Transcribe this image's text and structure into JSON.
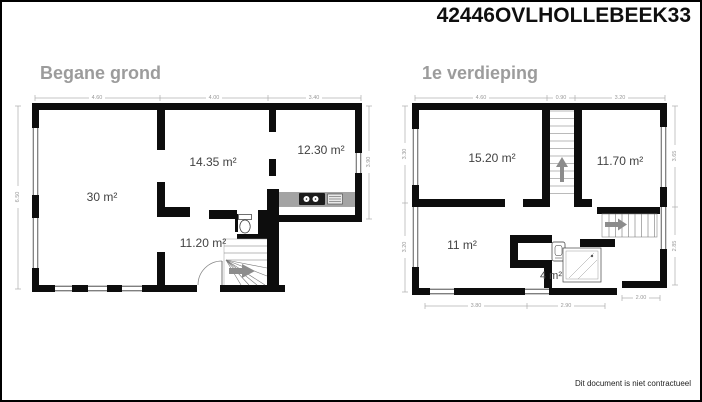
{
  "header": {
    "title": "42446OVLHOLLEBEEK33"
  },
  "footer": {
    "disclaimer": "Dit document is niet contractueel"
  },
  "ground_floor": {
    "title": "Begane grond",
    "rooms": {
      "living": "30 m²",
      "middle": "14.35 m²",
      "kitchen": "12.30 m²",
      "hall": "11.20 m²"
    },
    "dims": {
      "top_left": "4.60",
      "top_mid": "4.00",
      "top_right": "3.40",
      "left": "6.50",
      "right": "3.90"
    }
  },
  "first_floor": {
    "title": "1e verdieping",
    "rooms": {
      "bedroom_left": "15.20 m²",
      "bedroom_right": "11.70 m²",
      "bedroom_bottom": "11 m²",
      "bathroom": "4 m²"
    },
    "dims": {
      "top_left": "4.60",
      "top_mid": "0.90",
      "top_right": "3.20",
      "left_top": "3.30",
      "left_bottom": "3.20",
      "right_top": "3.65",
      "right_bottom": "2.85",
      "bottom_left": "3.80",
      "bottom_mid": "2.90",
      "bottom_right": "2.00"
    }
  },
  "colors": {
    "wall": "#0d0d0d",
    "counter": "#a3a3a3",
    "title_gray": "#9c9c9c",
    "dim_gray": "#999999",
    "arrow_gray": "#8c8c8c"
  }
}
